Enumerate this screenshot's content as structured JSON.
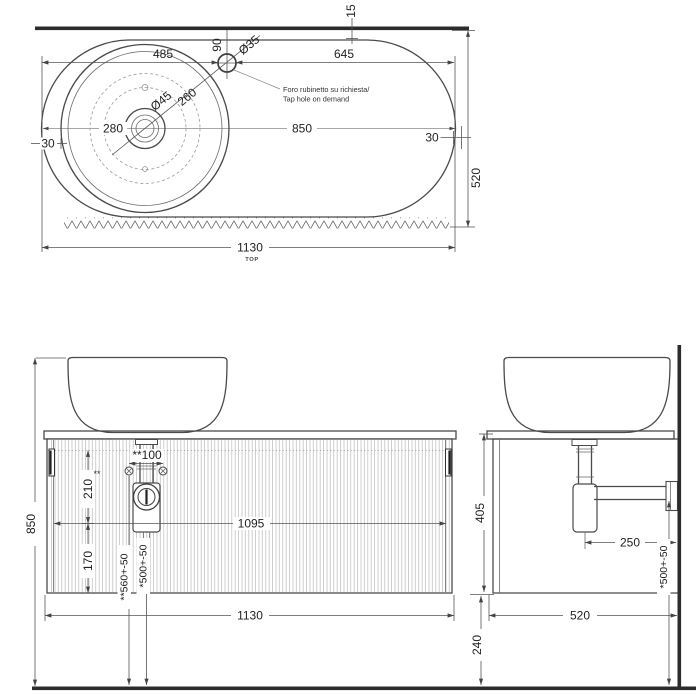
{
  "top_view": {
    "view_label": "TOP",
    "note_line1": "Foro rubinetto su richiesta/",
    "note_line2": "Tap hole on demand",
    "dim_485": "485",
    "dim_645": "645",
    "dim_90": "90",
    "dim_dia35": "Ø35",
    "dim_dia45": "Ø45",
    "dim_260": "260",
    "dim_280": "280",
    "dim_850": "850",
    "dim_30_left": "30",
    "dim_30_right": "30",
    "dim_520": "520",
    "dim_15": "15",
    "dim_1130": "1130"
  },
  "front_view": {
    "dim_850": "850",
    "dim_100": "**100",
    "footnote_marker": "**",
    "dim_210": "210",
    "dim_170": "170",
    "dim_1095": "1095",
    "dim_560": "**560+-50",
    "dim_500": "*500+-50",
    "dim_1130": "1130"
  },
  "side_view": {
    "dim_405": "405",
    "dim_250": "250",
    "dim_500": "*500+-50",
    "dim_520": "520",
    "dim_240": "240"
  }
}
